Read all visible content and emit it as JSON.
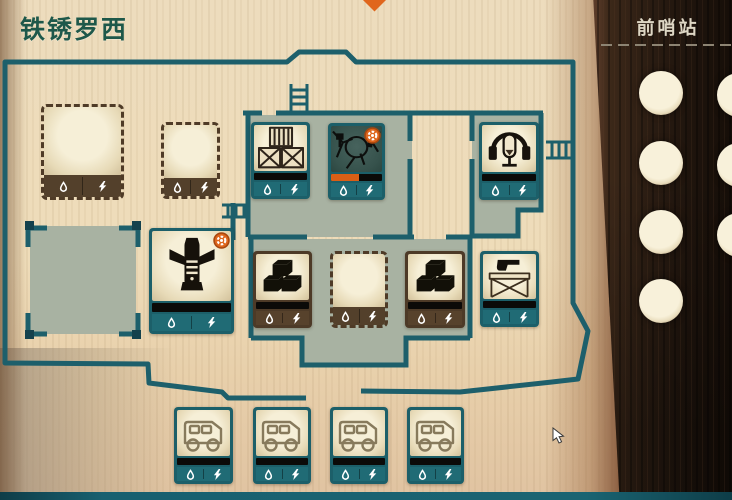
{
  "window": {
    "title": "铁锈罗西"
  },
  "right_panel": {
    "label": "前哨站",
    "portholes": {
      "left_column": [
        {
          "cx": 661,
          "cy": 93
        },
        {
          "cx": 661,
          "cy": 163
        },
        {
          "cx": 661,
          "cy": 232
        },
        {
          "cx": 661,
          "cy": 301
        }
      ],
      "right_column": [
        {
          "cx": 739,
          "cy": 95
        },
        {
          "cx": 739,
          "cy": 165
        },
        {
          "cx": 739,
          "cy": 235
        }
      ],
      "radius": 22
    }
  },
  "colors": {
    "wall_teal": "#1d5f6b",
    "room_sage": "#a8b2a2",
    "slot_brown": "#4f3b27",
    "alert_orange": "#df661c",
    "title_green": "#1e584a",
    "panel_wood": "#2a1c12",
    "bottom_bar": "#186070"
  },
  "tiles": [
    {
      "id": "storage-slot-large",
      "kind": "empty-slot",
      "icon": null,
      "variant": "slot large",
      "x": 41,
      "y": 104,
      "w": 83,
      "h": 96
    },
    {
      "id": "storage-slot-1",
      "kind": "empty-slot",
      "icon": null,
      "variant": "slot",
      "x": 161,
      "y": 122,
      "w": 59,
      "h": 77
    },
    {
      "id": "crates",
      "kind": "item",
      "icon": "crates",
      "variant": "teal",
      "x": 251,
      "y": 122,
      "w": 59,
      "h": 77,
      "bar": true
    },
    {
      "id": "broken-machine",
      "kind": "item",
      "icon": "machine",
      "variant": "teal",
      "x": 328,
      "y": 123,
      "w": 57,
      "h": 77,
      "bar": true,
      "dark": true,
      "badge": true,
      "progress_pct": 55
    },
    {
      "id": "radio",
      "kind": "item",
      "icon": "radio",
      "variant": "teal",
      "x": 479,
      "y": 122,
      "w": 60,
      "h": 78,
      "bar": true
    },
    {
      "id": "workbench",
      "kind": "item",
      "icon": "workbench",
      "variant": "teal large",
      "x": 149,
      "y": 228,
      "w": 85,
      "h": 106,
      "bar": true,
      "badge": true
    },
    {
      "id": "bricks-1",
      "kind": "item",
      "icon": "bricks",
      "variant": "brown",
      "x": 253,
      "y": 251,
      "w": 59,
      "h": 77,
      "bar": true
    },
    {
      "id": "storage-slot-2",
      "kind": "empty-slot",
      "icon": null,
      "variant": "slot",
      "x": 330,
      "y": 251,
      "w": 58,
      "h": 77
    },
    {
      "id": "bricks-2",
      "kind": "item",
      "icon": "bricks",
      "variant": "brown",
      "x": 405,
      "y": 251,
      "w": 60,
      "h": 77,
      "bar": true
    },
    {
      "id": "gun-rack",
      "kind": "item",
      "icon": "gun-rack",
      "variant": "teal",
      "x": 480,
      "y": 251,
      "w": 59,
      "h": 76,
      "bar": true
    },
    {
      "id": "vehicle-1",
      "kind": "item",
      "icon": "vehicle",
      "variant": "teal",
      "x": 174,
      "y": 407,
      "w": 59,
      "h": 77,
      "bar": true
    },
    {
      "id": "vehicle-2",
      "kind": "item",
      "icon": "vehicle",
      "variant": "teal",
      "x": 253,
      "y": 407,
      "w": 58,
      "h": 77,
      "bar": true
    },
    {
      "id": "vehicle-3",
      "kind": "item",
      "icon": "vehicle",
      "variant": "teal",
      "x": 330,
      "y": 407,
      "w": 58,
      "h": 77,
      "bar": true
    },
    {
      "id": "vehicle-4",
      "kind": "item",
      "icon": "vehicle",
      "variant": "teal",
      "x": 407,
      "y": 407,
      "w": 57,
      "h": 77,
      "bar": true
    }
  ],
  "cursor": {
    "x": 552,
    "y": 427
  }
}
